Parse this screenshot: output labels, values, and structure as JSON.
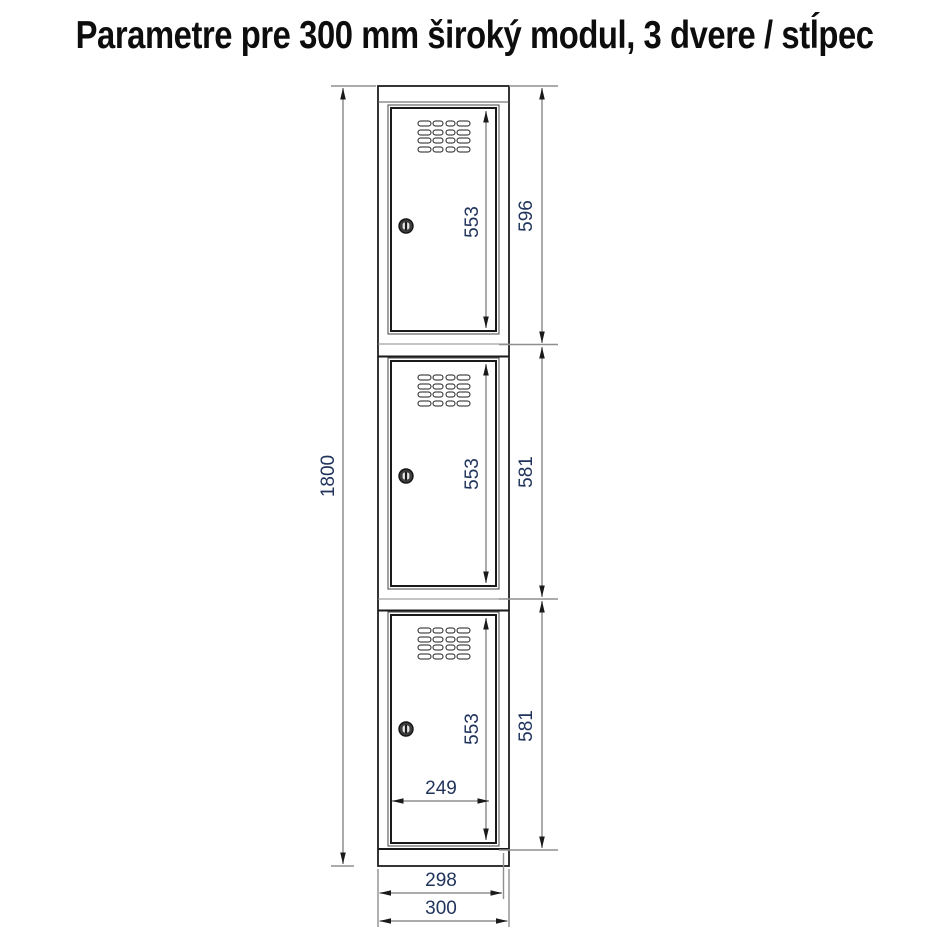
{
  "title": "Parametre pre 300 mm široký modul, 3 dvere / stĺpec",
  "colors": {
    "dimension_text": "#21345c",
    "dimension_line": "#8f8f8f",
    "outline": "#1f1f1f",
    "background": "#ffffff"
  },
  "diagram": {
    "total_height": "1800",
    "door_opening_height": "553",
    "section_heights": {
      "top": "596",
      "middle": "581",
      "bottom": "581"
    },
    "compartment_inner_width": "249",
    "body_width": "298",
    "module_width": "300"
  }
}
